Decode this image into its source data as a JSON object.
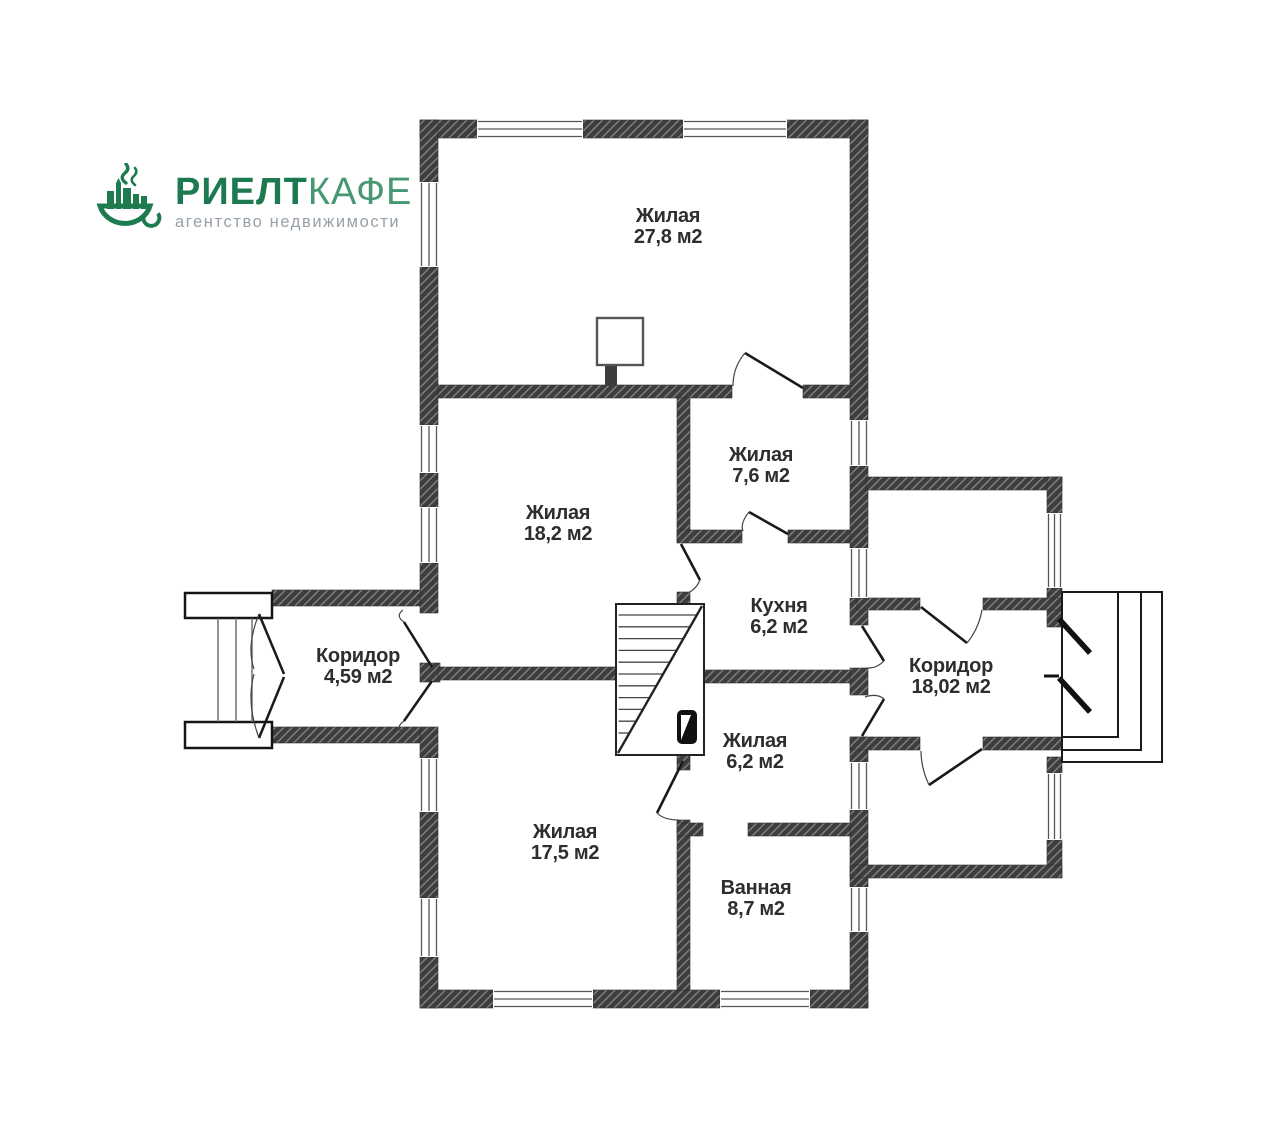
{
  "logo": {
    "brand_primary": "РИЕЛТ",
    "brand_secondary": "КАФЕ",
    "tagline": "агентство недвижимости",
    "colors": {
      "primary_green": "#1d7a50",
      "secondary_green": "#459872",
      "tagline_gray": "#97a0a8"
    }
  },
  "floor_plan": {
    "wall_color": "#3d3d3d",
    "background": "#ffffff",
    "rooms": [
      {
        "id": "living-27-8",
        "name": "Жилая",
        "area": "27,8 м2"
      },
      {
        "id": "living-18-2",
        "name": "Жилая",
        "area": "18,2 м2"
      },
      {
        "id": "living-7-6",
        "name": "Жилая",
        "area": "7,6 м2"
      },
      {
        "id": "kitchen",
        "name": "Кухня",
        "area": "6,2 м2"
      },
      {
        "id": "corridor-small",
        "name": "Коридор",
        "area": "4,59 м2"
      },
      {
        "id": "corridor-large",
        "name": "Коридор",
        "area": "18,02 м2"
      },
      {
        "id": "living-6-2",
        "name": "Жилая",
        "area": "6,2 м2"
      },
      {
        "id": "living-17-5",
        "name": "Жилая",
        "area": "17,5 м2"
      },
      {
        "id": "bathroom",
        "name": "Ванная",
        "area": "8,7 м2"
      }
    ]
  }
}
